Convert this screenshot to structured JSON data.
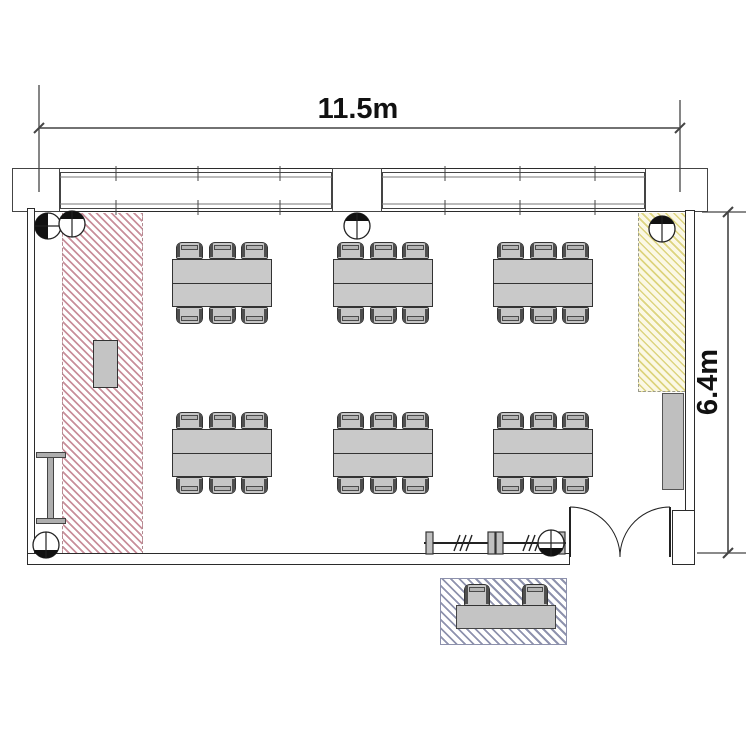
{
  "labels": {
    "width_dimension": "11.5m",
    "depth_dimension": "6.4m"
  },
  "floorplan": {
    "room_type": "seminar-room",
    "tables": {
      "count": 6,
      "grid": "2 rows x 3 columns",
      "chairs_per_table": 6,
      "positions": [
        [
          172,
          259
        ],
        [
          333,
          259
        ],
        [
          493,
          259
        ],
        [
          172,
          429
        ],
        [
          333,
          429
        ],
        [
          493,
          429
        ]
      ],
      "size": [
        100,
        48
      ],
      "chair_size": [
        27,
        17
      ],
      "chair_offsets": [
        4,
        36.5,
        69
      ]
    },
    "ceiling_fixtures": [
      {
        "x": 48,
        "y": 226,
        "fill": "left"
      },
      {
        "x": 72,
        "y": 224,
        "fill": "top"
      },
      {
        "x": 357,
        "y": 226,
        "fill": "top"
      },
      {
        "x": 662,
        "y": 229,
        "fill": "top"
      },
      {
        "x": 46,
        "y": 545,
        "fill": "bottom"
      },
      {
        "x": 551,
        "y": 543,
        "fill": "bottom-cross"
      }
    ],
    "windows": [
      {
        "x1": 60,
        "x2": 332,
        "ticks": [
          116,
          198,
          280
        ]
      },
      {
        "x1": 382,
        "x2": 645,
        "ticks": [
          445,
          520,
          595
        ]
      }
    ],
    "railing": {
      "x1": 424,
      "x2": 566,
      "y": 543,
      "posts": [
        426,
        488,
        496,
        558
      ],
      "breaks": [
        463,
        532
      ]
    },
    "zones": {
      "presentation_zone": {
        "hatch_color": "#c98f9b",
        "position": "left-strip"
      },
      "side_zone": {
        "hatch_color": "#ddd47f",
        "fill": "#fbf8e5",
        "position": "right-top"
      },
      "entrance_bench_zone": {
        "hatch_color": "#8e92ad",
        "position": "outside-bottom"
      }
    }
  },
  "colors": {
    "wall_line": "#2b2b2b",
    "furniture_fill": "#c9c9c9",
    "dimension_line": "#444444"
  }
}
